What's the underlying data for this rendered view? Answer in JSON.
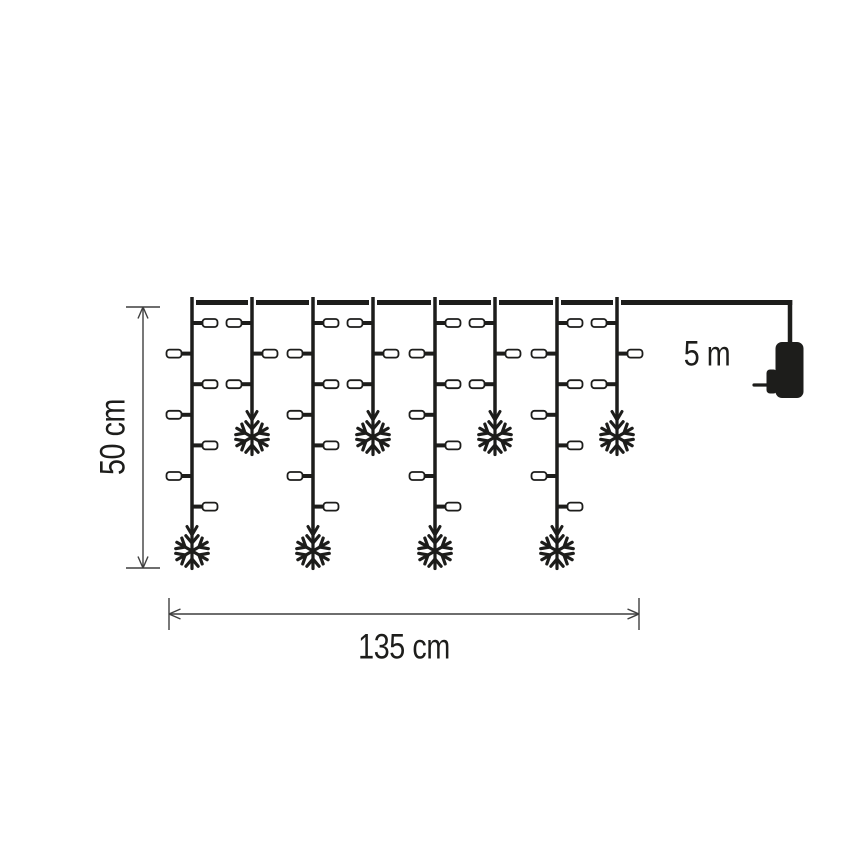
{
  "labels": {
    "height": "50 cm",
    "width": "135 cm",
    "lead_length": "5 m"
  },
  "colors": {
    "background": "#ffffff",
    "line": "#1d1d1b",
    "bulb_fill": "#ffffff",
    "dimension": "#3f3f3f",
    "text": "#1d1d1b"
  },
  "figure": {
    "cable": {
      "y": 302.5,
      "thickness": 5,
      "top_extend_y": 297,
      "gap": 4,
      "lead_corner_x": 790,
      "lead_drop_bottom_y": 344,
      "lead_drop_width": 4.5
    },
    "drops": [
      {
        "x": 192,
        "kind": "long"
      },
      {
        "x": 252,
        "kind": "short"
      },
      {
        "x": 313,
        "kind": "long"
      },
      {
        "x": 373,
        "kind": "short"
      },
      {
        "x": 435,
        "kind": "long"
      },
      {
        "x": 495,
        "kind": "short"
      },
      {
        "x": 557,
        "kind": "long"
      },
      {
        "x": 617,
        "kind": "short"
      }
    ],
    "kinds": {
      "long": {
        "bulbs": 7,
        "first_side": "right",
        "arrow_tip_y": 535,
        "snowflake_cy": 551
      },
      "short": {
        "bulbs": 3,
        "first_side": "left",
        "arrow_tip_y": 420,
        "snowflake_cy": 437
      }
    },
    "drop_line_width": 3.5,
    "drop_arrow": {
      "half_width": 5,
      "length": 8.5,
      "stroke": 3
    },
    "bulb": {
      "row_start_y": 323,
      "row_step": 30.6,
      "stub_len": 11,
      "stub_width": 4,
      "w": 15,
      "h": 8,
      "rx": 3,
      "border": 1.8
    },
    "snowflake": {
      "arm": 17.5,
      "fork_start": 8,
      "fork_len": 9.5,
      "fork_angle_deg": 40,
      "stroke": 3.2
    },
    "dims": {
      "stroke": 1.4,
      "arrow_len": 11.5,
      "arrow_half": 5,
      "height": {
        "x": 143,
        "y1": 307,
        "y2": 568,
        "tick_x1": 126,
        "tick_x2": 160
      },
      "width": {
        "y": 614,
        "x1": 169,
        "x2": 639,
        "tick_y1": 598,
        "tick_y2": 630
      }
    },
    "plug": {
      "pin": {
        "x1": 754,
        "x2": 769,
        "y": 385,
        "stroke": 3.2
      },
      "tab": {
        "x": 766.5,
        "y": 369.5,
        "w": 10.5,
        "h": 24,
        "rx": 3.5
      },
      "body": {
        "x": 775.5,
        "y": 342,
        "w": 28,
        "h": 56,
        "rx": 6.5
      }
    }
  }
}
